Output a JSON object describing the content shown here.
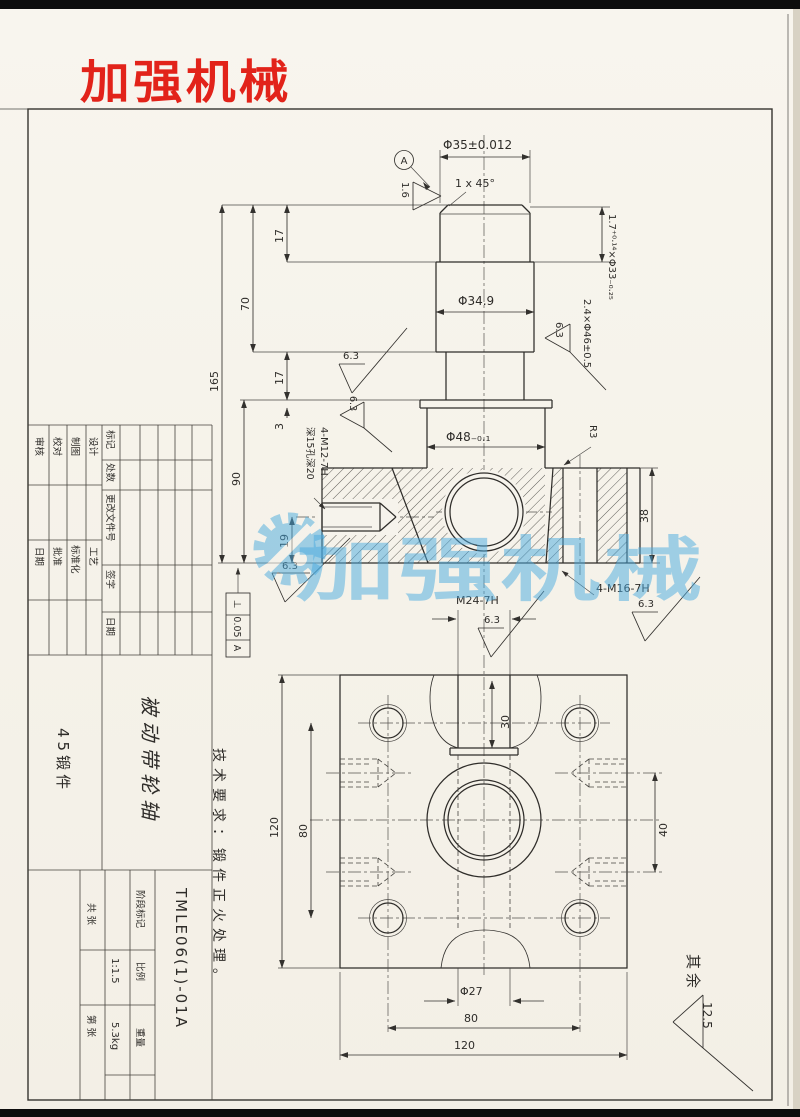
{
  "colors": {
    "accent_red": "#e2231a",
    "watermark_blue": "#49aade",
    "ink": "#2f2d2a",
    "paper": "#f6f3ec"
  },
  "logo": {
    "text": "加强机械"
  },
  "watermark": {
    "text": "加强机械"
  },
  "upper": {
    "dia35": "Φ35±0.012",
    "chamfer": "1 x 45°",
    "datum_a": "A",
    "finish16": "1.6",
    "groove1": "1.7⁺⁰·¹⁴×Φ33₋₀.₂₅",
    "groove2": "2.4×Φ46±0.5",
    "dia349": "Φ34.9",
    "dia48": "Φ48₋₀.₁",
    "r3": "R3",
    "d17a": "17",
    "d70": "70",
    "d165": "165",
    "d17b": "17",
    "d3": "3",
    "d90": "90",
    "d19": "19",
    "d38": "38",
    "f63": "6.3",
    "tap_side_1": "4-M12-7H",
    "tap_side_2": "深15孔深20",
    "tap_bottom": "4-M16-7H",
    "perp_sym": "⊥",
    "perp_val": "0.05",
    "perp_datum": "A"
  },
  "lower": {
    "m24": "M24-7H",
    "f63": "6.3",
    "d30": "30",
    "d120l": "120",
    "d80l": "80",
    "d40": "40",
    "dia27": "Φ27",
    "d80b": "80",
    "d120b": "120"
  },
  "notes": {
    "tech": "技术要求：锻件正火处理。",
    "rest_label": "其余",
    "rest_value": "12.5"
  },
  "tb": {
    "mark": "标记",
    "qty": "处数",
    "doc": "更改文件号",
    "sign": "签字",
    "date": "日期",
    "design": "设计",
    "draft": "制图",
    "check": "校对",
    "audit": "审核",
    "craft": "工艺",
    "std": "标准化",
    "approve": "批准",
    "date2": "日期",
    "name": "被动带轮轴",
    "material": "45锻件",
    "no": "TMLE06(1)-01A",
    "stage": "阶段标记",
    "scale_l": "比例",
    "scale_v": "1:1.5",
    "weight_l": "重量",
    "weight_v": "5.3kg",
    "sheets_total": "共 张",
    "sheets_no": "第 张"
  }
}
